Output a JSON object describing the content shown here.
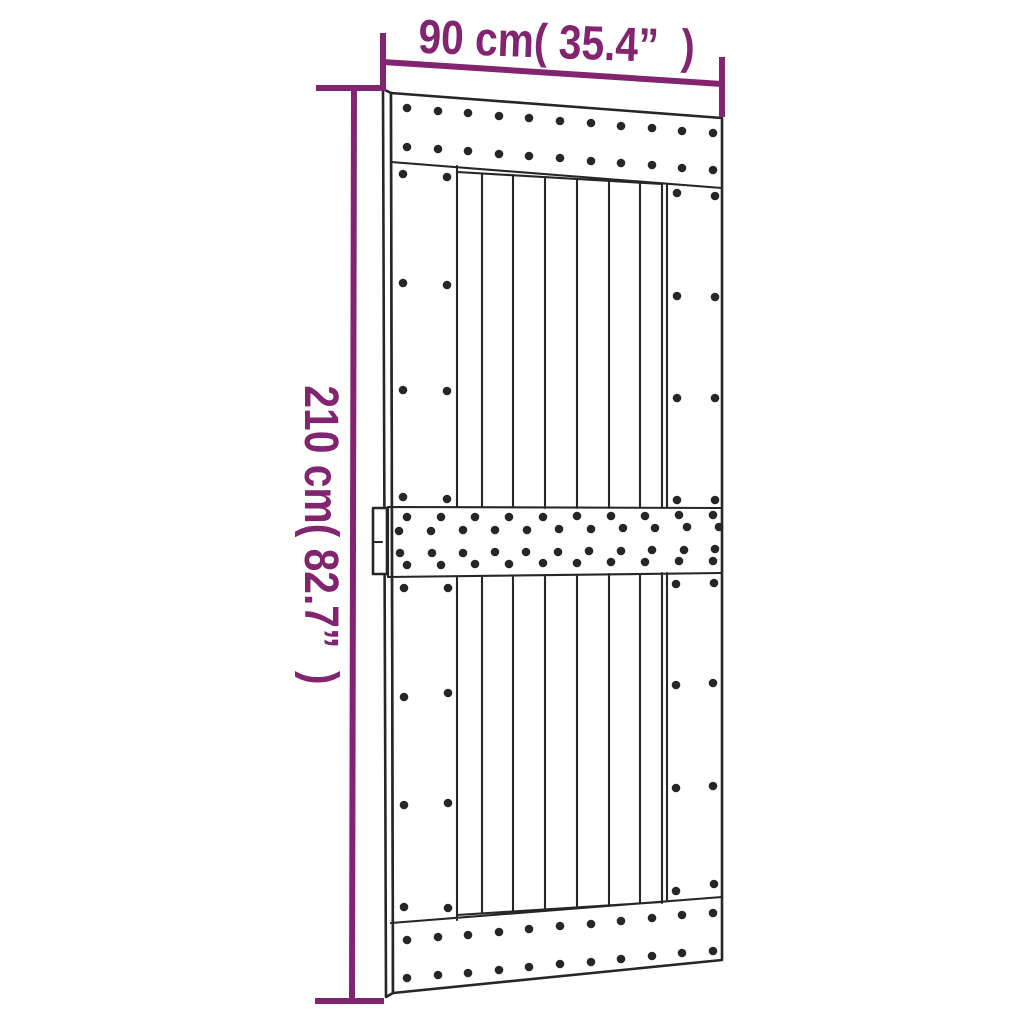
{
  "diagram": {
    "type": "product-dimension-diagram",
    "subject": "sliding barn door with top, middle and bottom rails, vertical planks, nail dots and side handle",
    "width_label": "90 cm( 35.4”  )",
    "height_label": "210 cm( 82.7”  )",
    "colors": {
      "dimension_accent": "#82246f",
      "outline": "#262626",
      "fill": "#ffffff",
      "background": "#ffffff"
    },
    "dots": {
      "top_rail": [
        [
          407,
          108
        ],
        [
          438,
          111
        ],
        [
          468,
          113
        ],
        [
          499,
          116
        ],
        [
          529,
          118
        ],
        [
          560,
          121
        ],
        [
          591,
          123
        ],
        [
          621,
          126
        ],
        [
          652,
          128
        ],
        [
          682,
          131
        ],
        [
          713,
          133
        ],
        [
          407,
          147
        ],
        [
          438,
          149
        ],
        [
          468,
          151
        ],
        [
          499,
          154
        ],
        [
          529,
          156
        ],
        [
          560,
          158
        ],
        [
          591,
          161
        ],
        [
          621,
          163
        ],
        [
          652,
          165
        ],
        [
          682,
          168
        ],
        [
          713,
          170
        ]
      ],
      "middle_rail": [
        [
          407,
          517
        ],
        [
          441,
          517
        ],
        [
          475,
          517
        ],
        [
          509,
          517
        ],
        [
          543,
          517
        ],
        [
          577,
          516
        ],
        [
          611,
          516
        ],
        [
          645,
          516
        ],
        [
          679,
          515
        ],
        [
          713,
          515
        ],
        [
          399,
          531
        ],
        [
          431,
          531
        ],
        [
          463,
          530
        ],
        [
          495,
          530
        ],
        [
          527,
          530
        ],
        [
          559,
          529
        ],
        [
          591,
          529
        ],
        [
          623,
          528
        ],
        [
          655,
          528
        ],
        [
          687,
          527
        ],
        [
          719,
          527
        ],
        [
          400,
          553
        ],
        [
          432,
          553
        ],
        [
          463,
          553
        ],
        [
          495,
          552
        ],
        [
          526,
          552
        ],
        [
          558,
          552
        ],
        [
          589,
          551
        ],
        [
          621,
          551
        ],
        [
          652,
          550
        ],
        [
          684,
          550
        ],
        [
          715,
          549
        ],
        [
          407,
          565
        ],
        [
          441,
          565
        ],
        [
          475,
          564
        ],
        [
          509,
          564
        ],
        [
          543,
          563
        ],
        [
          577,
          563
        ],
        [
          611,
          562
        ],
        [
          645,
          562
        ],
        [
          679,
          561
        ],
        [
          713,
          561
        ]
      ],
      "bottom_rail": [
        [
          407,
          940
        ],
        [
          438,
          937
        ],
        [
          468,
          935
        ],
        [
          499,
          932
        ],
        [
          529,
          929
        ],
        [
          560,
          926
        ],
        [
          591,
          924
        ],
        [
          621,
          921
        ],
        [
          652,
          918
        ],
        [
          682,
          915
        ],
        [
          713,
          913
        ],
        [
          407,
          978
        ],
        [
          438,
          975
        ],
        [
          468,
          973
        ],
        [
          499,
          970
        ],
        [
          529,
          967
        ],
        [
          560,
          964
        ],
        [
          591,
          962
        ],
        [
          621,
          959
        ],
        [
          652,
          956
        ],
        [
          682,
          953
        ],
        [
          713,
          951
        ]
      ],
      "left_stile_upper": [
        [
          403,
          174
        ],
        [
          447,
          177
        ],
        [
          403,
          283
        ],
        [
          447,
          285
        ],
        [
          403,
          390
        ],
        [
          447,
          391
        ],
        [
          403,
          497
        ],
        [
          447,
          499
        ]
      ],
      "right_stile_upper": [
        [
          677,
          193
        ],
        [
          715,
          196
        ],
        [
          677,
          296
        ],
        [
          715,
          297
        ],
        [
          677,
          398
        ],
        [
          715,
          398
        ],
        [
          677,
          500
        ],
        [
          715,
          500
        ]
      ],
      "left_stile_lower": [
        [
          404,
          588
        ],
        [
          448,
          588
        ],
        [
          404,
          697
        ],
        [
          448,
          693
        ],
        [
          404,
          805
        ],
        [
          448,
          803
        ],
        [
          404,
          907
        ],
        [
          448,
          908
        ]
      ],
      "right_stile_lower": [
        [
          676,
          584
        ],
        [
          714,
          583
        ],
        [
          676,
          685
        ],
        [
          713,
          683
        ],
        [
          676,
          788
        ],
        [
          713,
          786
        ],
        [
          676,
          891
        ],
        [
          714,
          884
        ]
      ]
    }
  }
}
